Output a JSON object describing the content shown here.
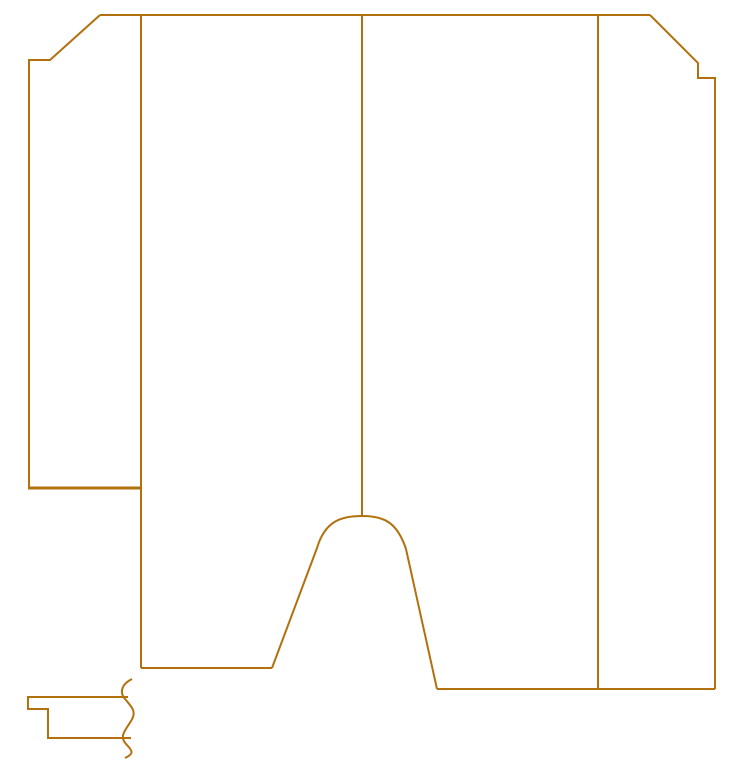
{
  "canvas": {
    "width": 734,
    "height": 767,
    "background_color": "#ffffff",
    "stroke_color": "#b2700e"
  },
  "drawing": {
    "type": "technical-line-drawing",
    "description": "carton-dieline-outline-with-break-line-profile",
    "paths": [
      {
        "name": "top-edge-line",
        "d": "M 100 15 L 650 15",
        "stroke_width": 2
      },
      {
        "name": "top-left-bevel-and-left-flap-edge",
        "d": "M 100 15 L 50 60 L 29 60 L 29 488",
        "stroke_width": 2
      },
      {
        "name": "left-flap-bottom-thick-line",
        "d": "M 28 488 L 142 488",
        "stroke_width": 3
      },
      {
        "name": "left-panel-edge-line",
        "d": "M 141 15 L 141 668",
        "stroke_width": 2
      },
      {
        "name": "left-panel-bottom-line",
        "d": "M 141 668 L 272 668",
        "stroke_width": 2
      },
      {
        "name": "bell-cutout-curve",
        "d": "M 272 668 L 317 548 C 325 521 341 516 362 516 C 384 516 397 522 406 549 L 437 689",
        "stroke_width": 2
      },
      {
        "name": "bottom-right-edge-line",
        "d": "M 437 689 L 715 689",
        "stroke_width": 2
      },
      {
        "name": "right-bevel-step-and-right-edge",
        "d": "M 650 15 L 698 63 L 698 78 L 715 78 L 715 689",
        "stroke_width": 2
      },
      {
        "name": "center-divider-line",
        "d": "M 362 15 L 362 516",
        "stroke_width": 2
      },
      {
        "name": "right-divider-line",
        "d": "M 598 15 L 598 689",
        "stroke_width": 2
      },
      {
        "name": "profile-section-outline",
        "d": "M 128 697 L 28 697 L 28 709 L 48 709 L 48 738 L 131 738",
        "stroke_width": 2
      },
      {
        "name": "break-line-squiggle",
        "d": "M 132 679 C 122 684 119 692 125 699 C 132 707 137 712 131 721 C 125 731 119 736 126 744 C 133 751 134 754 125 758",
        "stroke_width": 2
      }
    ]
  }
}
